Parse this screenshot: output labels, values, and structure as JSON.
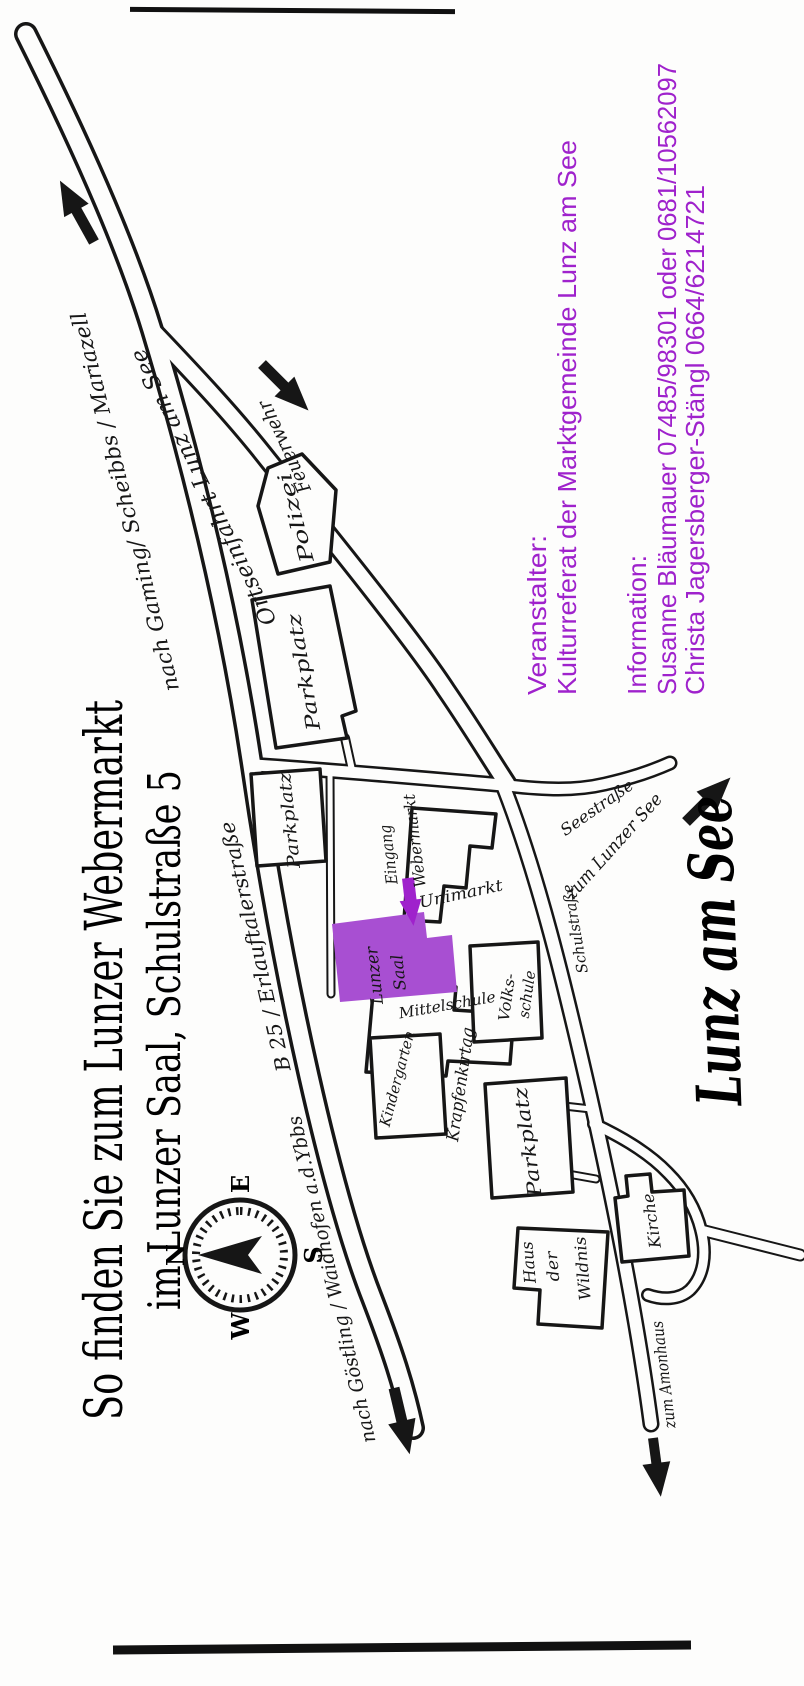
{
  "colors": {
    "ink": "#161616",
    "paper": "#fdfdfc",
    "purple_text": "#9f22cc",
    "purple_fill": "#a84fd2"
  },
  "title": {
    "line1": "So finden Sie zum Lunzer Webermarkt",
    "line2": "im Lunzer Saal, Schulstraße 5"
  },
  "contact": {
    "organizer_heading": "Veranstalter:",
    "organizer": "Kulturreferat der Marktgemeinde Lunz am See",
    "info_heading": "Information:",
    "info_line1": "Susanne Bläumauer  07485/98301 oder  0681/10562097",
    "info_line2": "Christa Jagersberger-Stängl  0664/6214721"
  },
  "map": {
    "town": "Lunz am See",
    "compass": {
      "n": "N",
      "e": "E",
      "s": "S",
      "w": "W"
    },
    "venue": {
      "line1": "Lunzer",
      "line2": "Saal"
    },
    "entrance": {
      "line1": "Eingang",
      "line2": "Webermarkt"
    },
    "event": "Krapfenkirtag",
    "buildings": {
      "unimarkt": "Unimarkt",
      "mittelschule": "Mittelschule",
      "kindergarten": "Kindergarten",
      "volksschule1": "Volks-",
      "volksschule2": "schule",
      "polizei": "Polizei",
      "feuerwehr": "Feuerwehr",
      "kirche": "Kirche",
      "wildnis1": "Haus",
      "wildnis2": "der",
      "wildnis3": "Wildnis",
      "parkplatz": "Parkplatz"
    },
    "streets": {
      "b25": "B 25 / Erlauftalerstraße",
      "schul": "Schulstraße",
      "see": "Seestraße",
      "orts": "Ortseinfahrt Lunz am See"
    },
    "directions": {
      "gaming": "nach Gaming/ Scheibbs / Mariazell",
      "goestling": "nach Göstling / Waidhofen a.d.Ybbs",
      "see": "zum Lunzer See",
      "amon": "zum Amonhaus"
    }
  }
}
